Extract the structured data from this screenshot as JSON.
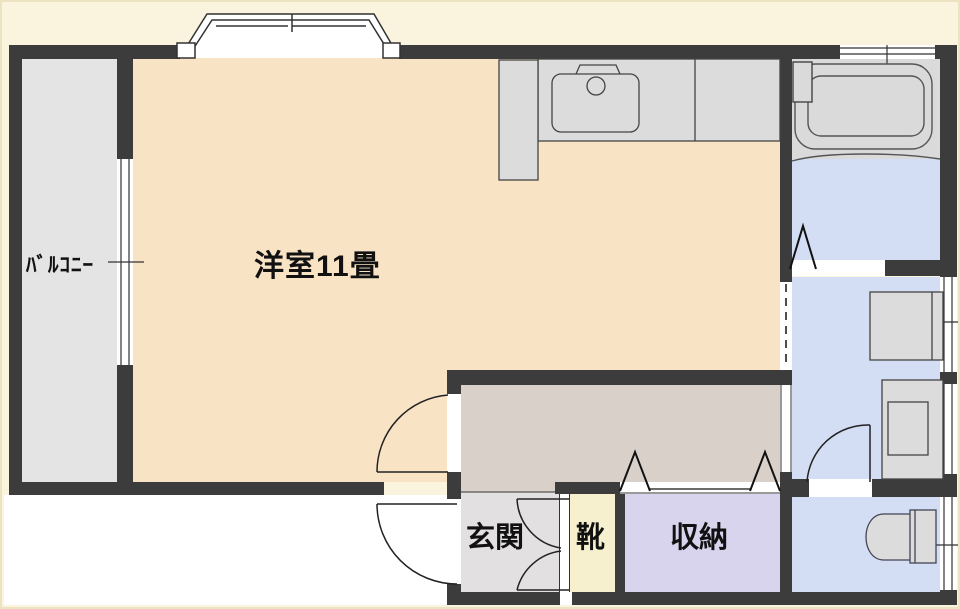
{
  "plan": {
    "type": "apartment-floorplan",
    "labels": {
      "balcony": "ﾊﾞﾙｺﾆｰ",
      "main_room": "洋室11畳",
      "entrance": "玄関",
      "shoes": "靴",
      "storage": "収納"
    },
    "rooms": [
      {
        "id": "balcony",
        "label": "ﾊﾞﾙｺﾆｰ",
        "color": "#e4e4e4"
      },
      {
        "id": "main-room",
        "label": "洋室11畳",
        "color": "#f8e3c5"
      },
      {
        "id": "hallway",
        "label": "",
        "color": "#d9d0c9"
      },
      {
        "id": "entrance",
        "label": "玄関",
        "color": "#e2e0e0"
      },
      {
        "id": "shoe-cabinet",
        "label": "靴",
        "color": "#f6f0cf"
      },
      {
        "id": "storage",
        "label": "収納",
        "color": "#d8d4ee"
      },
      {
        "id": "bathroom",
        "label": "",
        "color": "#dadada"
      },
      {
        "id": "washroom",
        "label": "",
        "color": "#d3ddf3"
      },
      {
        "id": "toilet",
        "label": "",
        "color": "#d3ddf3"
      }
    ],
    "fixtures": [
      "kitchen-counter",
      "kitchen-sink",
      "faucet",
      "bathtub",
      "washbasin-counter",
      "washing-machine",
      "toilet-bowl",
      "bay-window",
      "folding-doors",
      "swing-doors",
      "shoe-cabinet-doors"
    ],
    "colors": {
      "wall": "#3c3c3c",
      "outside": "#faf3dd",
      "outside_entry": "#ffffff",
      "main_room": "#f8e3c5",
      "balcony": "#e4e4e4",
      "hallway": "#d9d0c9",
      "entrance": "#e2e0e0",
      "shoes": "#f6f0cf",
      "storage": "#d8d4ee",
      "wet_rooms": "#d3ddf3",
      "bath_floor": "#dadada",
      "fixture_fill": "#dcdcdc",
      "line": "#333333"
    }
  }
}
